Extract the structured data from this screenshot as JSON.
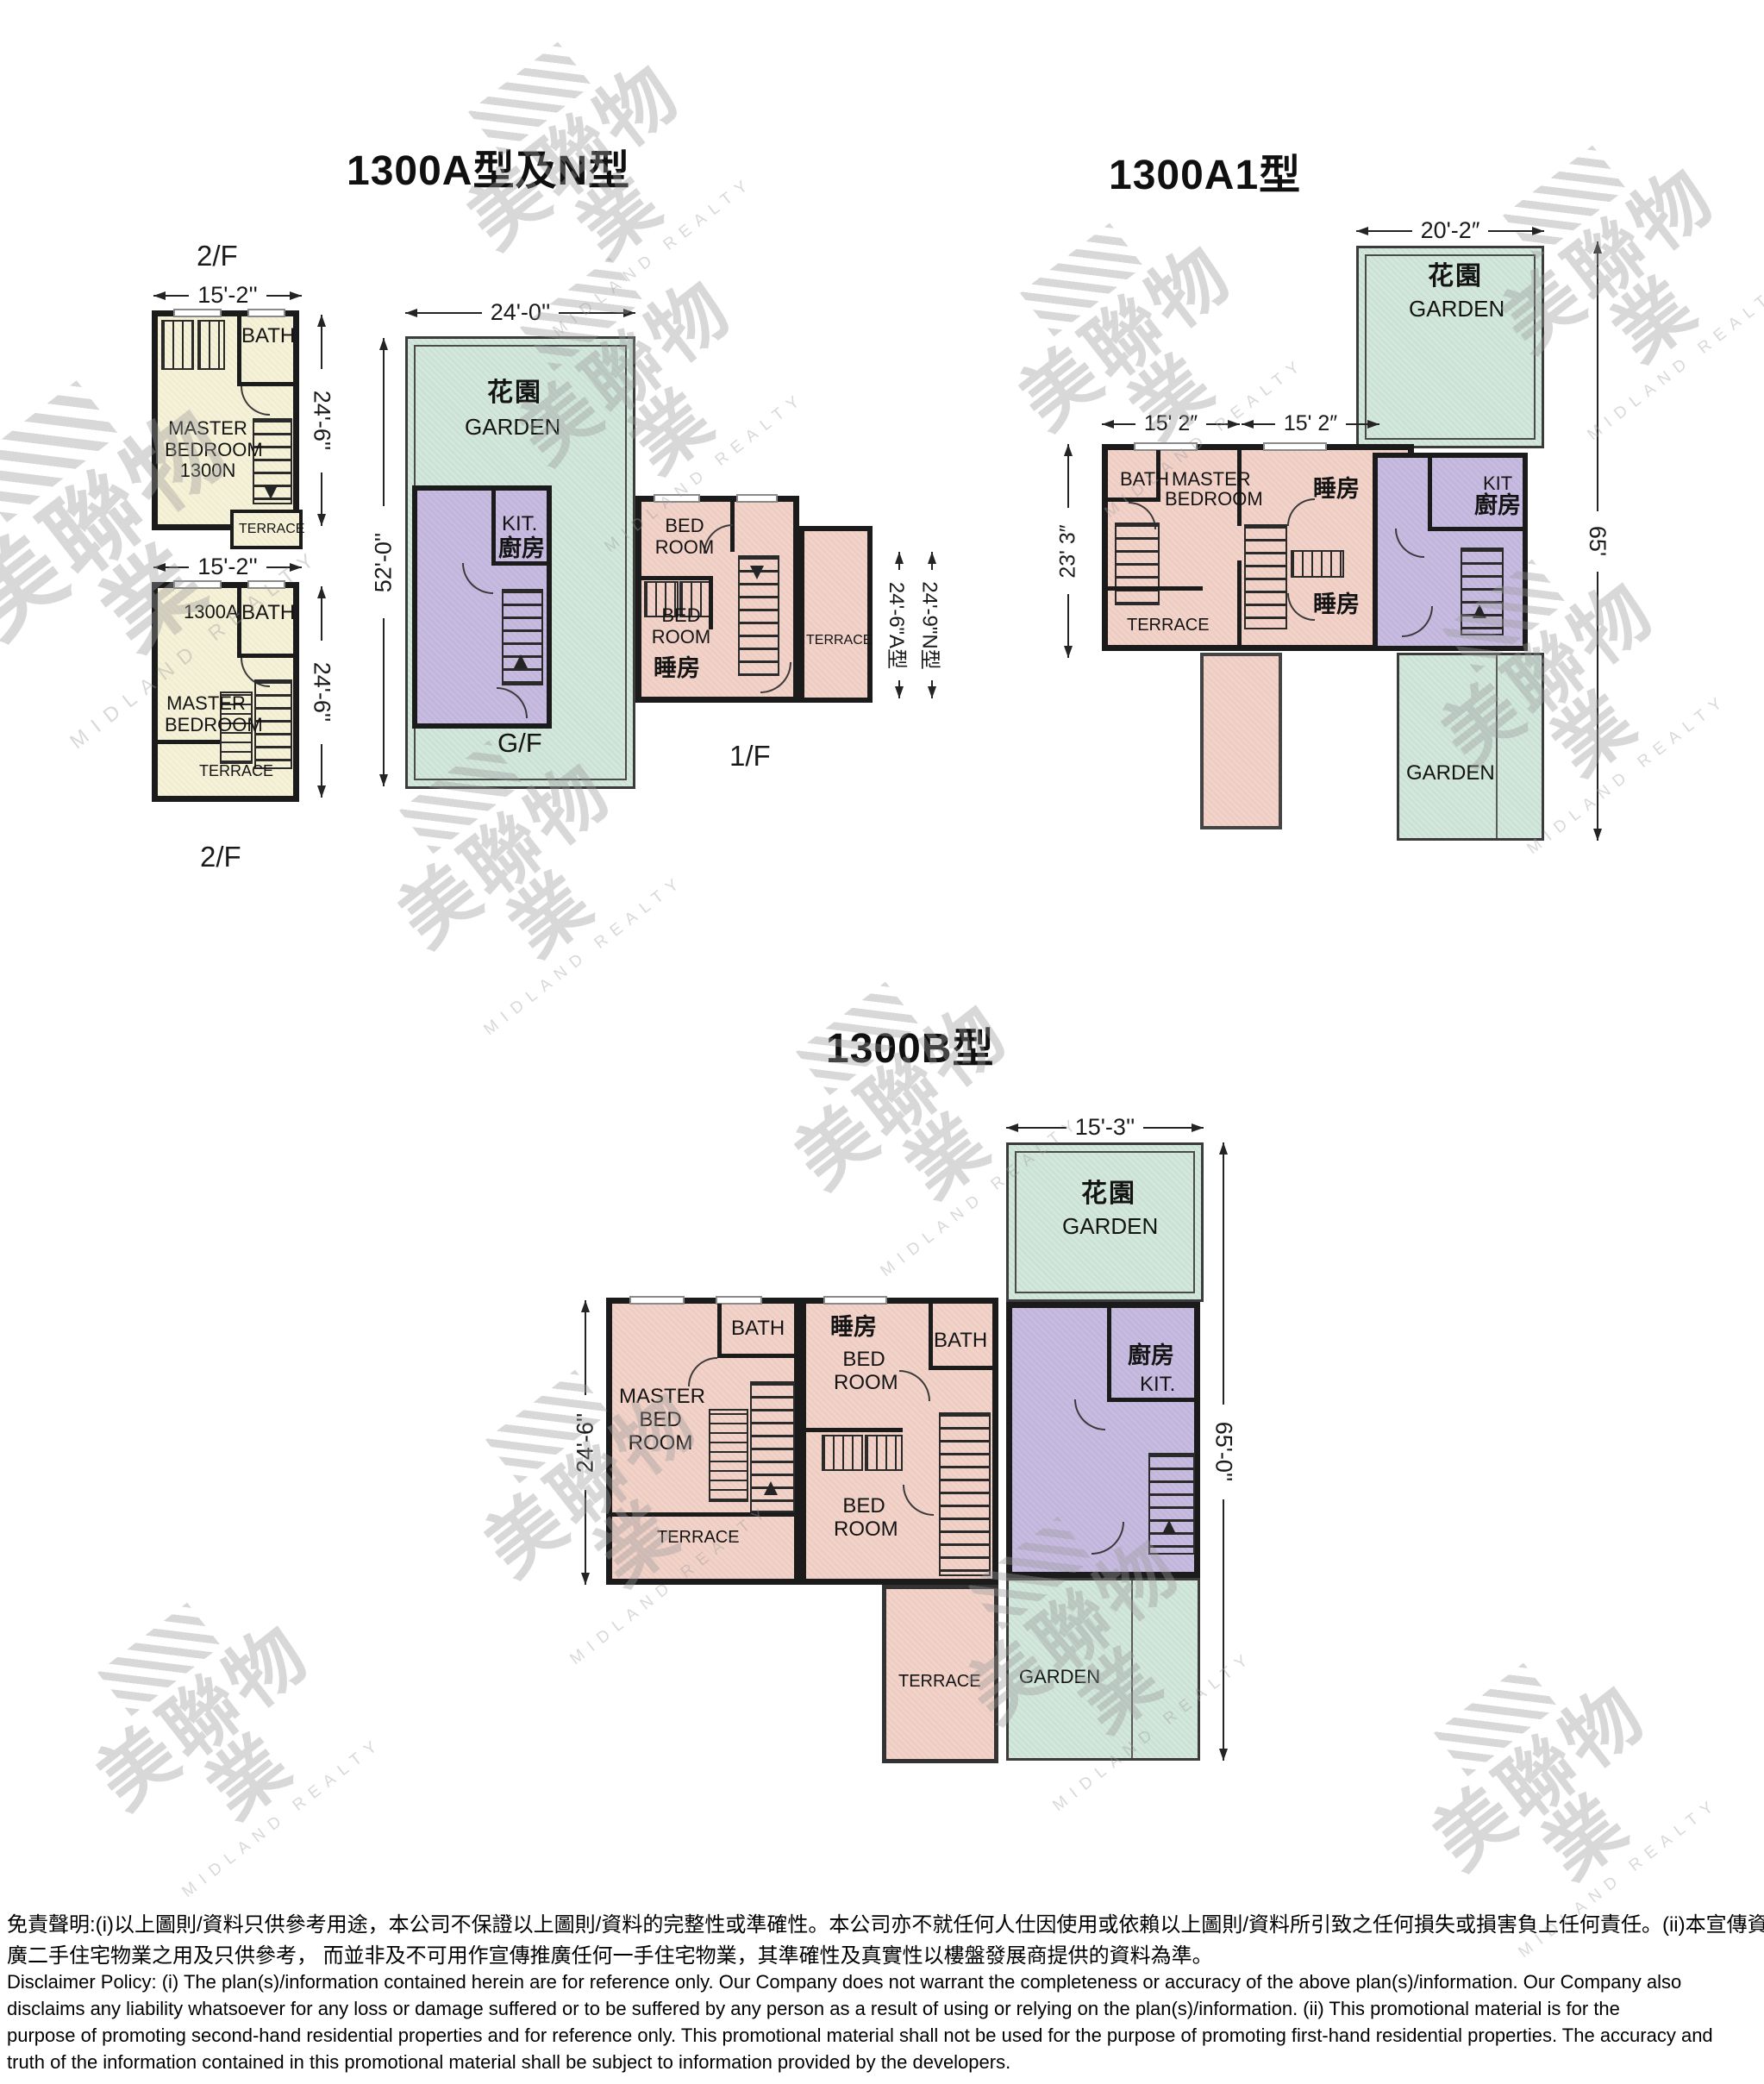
{
  "watermark": {
    "zh": "美聯物業",
    "en": "MIDLAND REALTY"
  },
  "plan_an": {
    "title": "1300A型及N型",
    "n2f": {
      "floor": "2/F",
      "wdim": "15'-2''",
      "hdim": "24'-6''",
      "bath": "BATH",
      "l1": "MASTER",
      "l2": "BEDROOM",
      "l3": "1300N",
      "terrace": "TERRACE"
    },
    "a2f": {
      "floor": "2/F",
      "wdim": "15'-2''",
      "hdim": "24'-6''",
      "unit": "1300A",
      "bath": "BATH",
      "l1": "MASTER",
      "l2": "BEDROOM",
      "terrace": "TERRACE"
    },
    "gf": {
      "floor": "G/F",
      "wdim": "24'-0''",
      "hdim": "52'-0''",
      "garden_zh": "花園",
      "garden_en": "GARDEN",
      "kit": "KIT.",
      "kitchen_zh": "廚房"
    },
    "ff": {
      "floor": "1/F",
      "bed1_l1": "BED",
      "bed1_l2": "ROOM",
      "bed2_l1": "BED",
      "bed2_l2": "ROOM",
      "bed2_zh": "睡房",
      "terrace": "TERRACE",
      "dim_a": "24'-6\"A型",
      "dim_n": "24'-9\"N型"
    }
  },
  "plan_a1": {
    "title": "1300A1型",
    "gdim": "20'-2″",
    "garden_zh": "花園",
    "garden_en": "GARDEN",
    "wdim1": "15' 2″",
    "wdim2": "15' 2″",
    "hdim": "65'",
    "ldim": "23' 3″",
    "bath": "BATH",
    "master_l1": "MASTER",
    "master_l2": "BEDROOM",
    "br1": "睡房",
    "br2": "睡房",
    "kit": "KIT",
    "kitchen_zh": "廚房",
    "terrace": "TERRACE",
    "garden2": "GARDEN"
  },
  "plan_b": {
    "title": "1300B型",
    "gdim": "15'-3''",
    "garden_zh": "花園",
    "garden_en": "GARDEN",
    "ldim": "24'-6''",
    "rdim": "65'-0''",
    "bath1": "BATH",
    "bath2": "BATH",
    "br_zh": "睡房",
    "br_l1": "BED",
    "br_l2": "ROOM",
    "m_l1": "MASTER",
    "m_l2": "BED",
    "m_l3": "ROOM",
    "b2_l1": "BED",
    "b2_l2": "ROOM",
    "kitchen_zh": "廚房",
    "kit": "KIT.",
    "terrace1": "TERRACE",
    "terrace2": "TERRACE",
    "garden2": "GARDEN"
  },
  "disclaimer": {
    "zh1": "免責聲明:(i)以上圖則/資料只供參考用途，本公司不保證以上圖則/資料的完整性或準確性。本公司亦不就任何人仕因使用或依賴以上圖則/資料所引致之任何損失或損害負上任何責任。(ii)本宣傳資料只可作宣傳及推",
    "zh2": "廣二手住宅物業之用及只供參考， 而並非及不可用作宣傳推廣任何一手住宅物業，其準確性及真實性以樓盤發展商提供的資料為準。",
    "en1": "Disclaimer Policy: (i) The plan(s)/information contained herein are for reference only. Our Company does not warrant the completeness or accuracy of the above plan(s)/information. Our Company also",
    "en2": "disclaims any liability whatsoever for any loss or damage suffered or to be suffered by any person as a result of using or relying on the plan(s)/information. (ii) This promotional material is for the",
    "en3": "purpose of promoting second-hand residential properties and for reference only. This promotional material shall not be used for the purpose of promoting first-hand residential properties. The accuracy and",
    "en4": "truth of the information contained in this promotional material shall be subject to information provided by the developers."
  }
}
